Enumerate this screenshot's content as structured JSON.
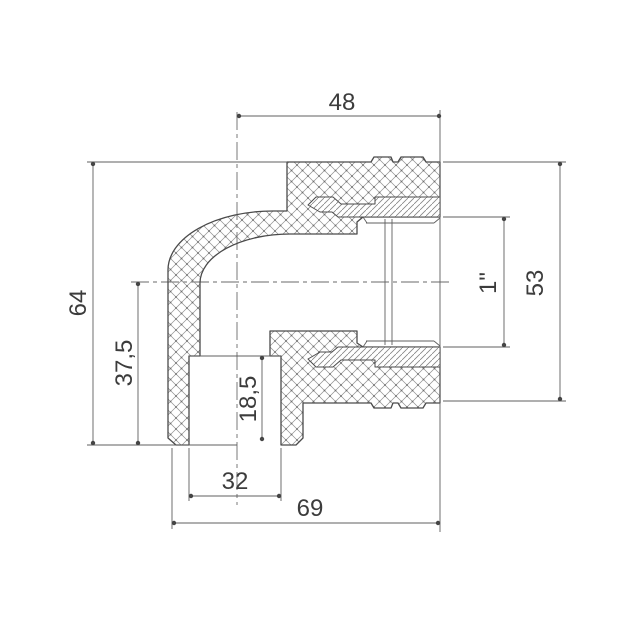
{
  "drawing": {
    "title": "90 degree elbow pipe fitting with threaded insert - section drawing",
    "dims": {
      "top_width": "48",
      "overall_height": "64",
      "lower_height": "37,5",
      "socket_depth": "18,5",
      "socket_width": "32",
      "overall_width": "69",
      "thread_size": "1\"",
      "right_height": "53"
    },
    "colors": {
      "line": "#4a4a4a",
      "thin_line": "#606060",
      "hatch": "#8f8f8f",
      "text": "#3c3c3c",
      "background": "#ffffff"
    }
  }
}
